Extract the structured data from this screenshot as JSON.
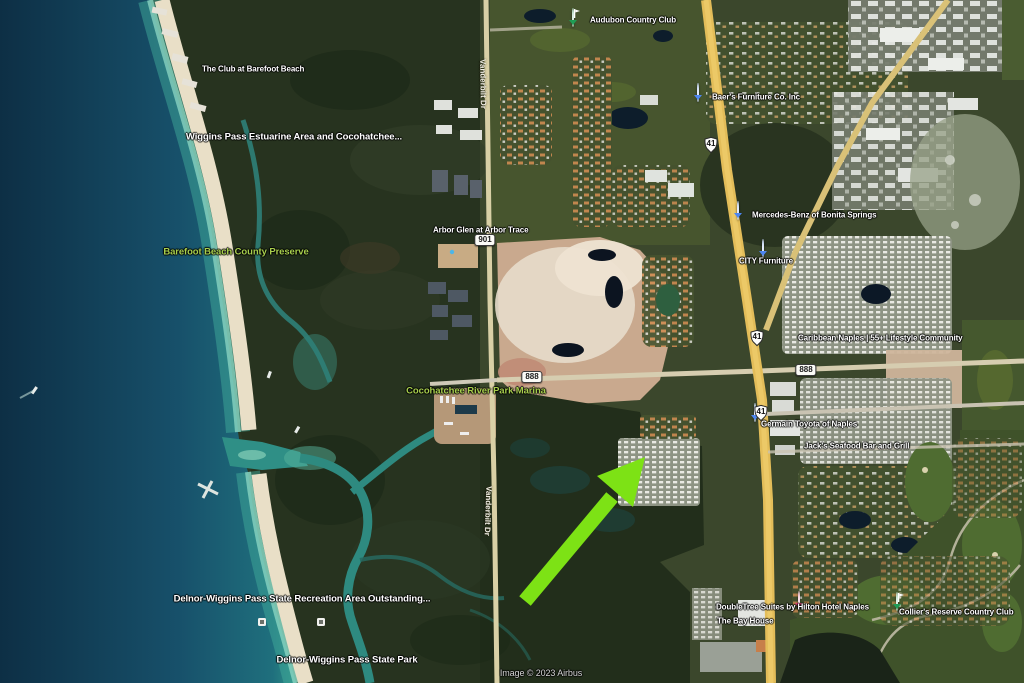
{
  "map": {
    "type": "satellite",
    "location": "North Naples / Wiggins Pass, Florida",
    "attribution": "Image © 2023 Airbus",
    "annotation": {
      "kind": "green-arrow",
      "color": "#7de215",
      "points_to": "gridded residential community east of Vanderbilt Dr"
    },
    "colors": {
      "ocean_deep": "#0d2f45",
      "ocean_shallow": "#2e8f86",
      "beach_sand": "#e9dfc7",
      "mangrove": "#232e1b",
      "highway_yellow": "#e3bd59",
      "park_label_green": "#a8cf4d"
    }
  },
  "pois": [
    {
      "id": "club-barefoot-beach",
      "text": "The Club at Barefoot Beach",
      "pin": "green-place-pin"
    },
    {
      "id": "wiggins-pass-estuarine",
      "text": "Wiggins Pass Estuarine Area and Cocohatchee...",
      "pin": null
    },
    {
      "id": "barefoot-beach-preserve",
      "text": "Barefoot Beach County Preserve",
      "pin": null
    },
    {
      "id": "audubon-country-club",
      "text": "Audubon Country Club",
      "pin": "golf-flag-pin"
    },
    {
      "id": "arbor-glen",
      "text": "Arbor Glen at Arbor Trace",
      "pin": "small-dot-pin"
    },
    {
      "id": "baers-furniture",
      "text": "Baer's Furniture Co. Inc",
      "pin": "furniture-store-pin"
    },
    {
      "id": "mercedes-benz-bonita",
      "text": "Mercedes-Benz of Bonita Springs",
      "pin": "car-dealer-pin"
    },
    {
      "id": "city-furniture",
      "text": "CITY Furniture",
      "pin": "furniture-store-pin"
    },
    {
      "id": "caribbean-naples",
      "text": "Caribbean Naples | 55+ Lifestyle Community",
      "pin": "community-pin"
    },
    {
      "id": "cocohatchee-river-park-marina",
      "text": "Cocohatchee River Park Marina",
      "pin": null
    },
    {
      "id": "germain-toyota",
      "text": "Germain Toyota of Naples",
      "pin": "car-dealer-pin"
    },
    {
      "id": "jacks-seafood",
      "text": "Jack's Seafood Bar and Grill",
      "pin": "restaurant-pin"
    },
    {
      "id": "doubletree-suites",
      "text": "DoubleTree Suites by Hilton Hotel Naples",
      "pin": "hotel-pin"
    },
    {
      "id": "bay-house",
      "text": "The Bay House",
      "pin": "restaurant-pin"
    },
    {
      "id": "colliers-reserve",
      "text": "Collier's Reserve Country Club",
      "pin": "golf-flag-pin"
    },
    {
      "id": "delnor-wiggins-recreation",
      "text": "Delnor-Wiggins Pass State Recreation Area Outstanding...",
      "pin": null
    },
    {
      "id": "delnor-wiggins-park",
      "text": "Delnor-Wiggins Pass State Park",
      "pin": null
    }
  ],
  "roads": {
    "vanderbilt_dr": "Vanderbilt Dr",
    "shield_41": "41",
    "shield_901": "901",
    "shield_888": "888"
  },
  "icons": {
    "green-place-pin": "#2f9e4f",
    "golf-flag-pin": "#1f9d55",
    "furniture-store-pin": "#4d86f0",
    "car-dealer-pin": "#4d86f0",
    "community-pin": "#e8457e",
    "hotel-pin": "#e8457e",
    "restaurant-pin": "#f09a33",
    "small-dot-pin": "#46b8bf"
  }
}
